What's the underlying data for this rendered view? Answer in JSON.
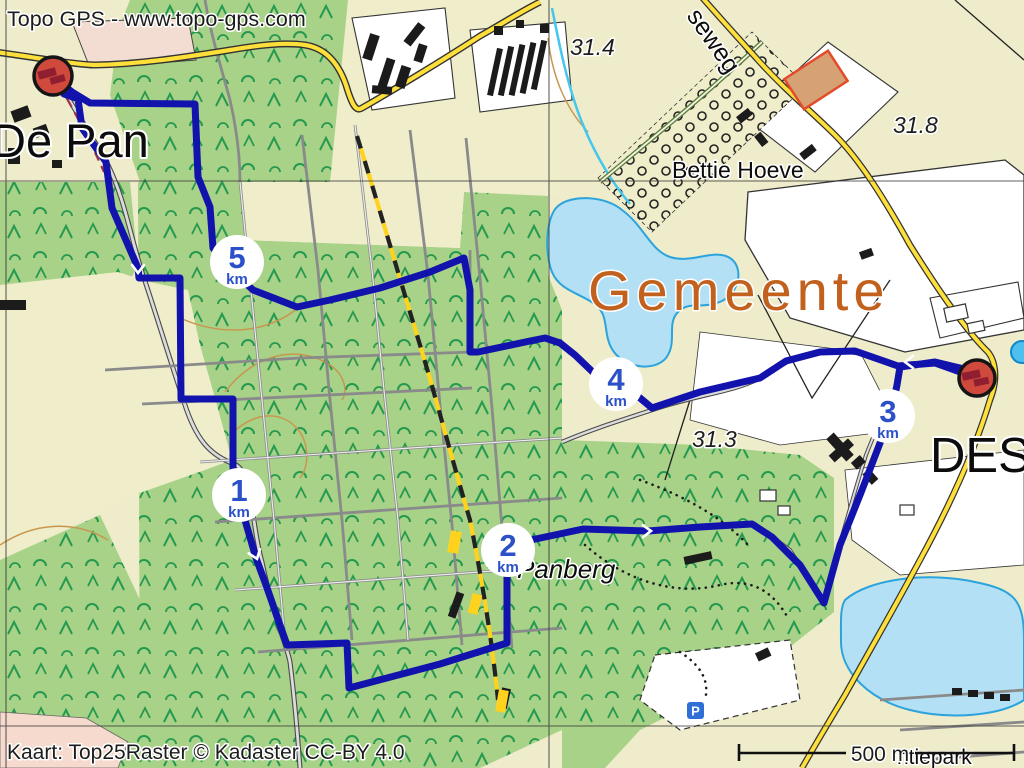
{
  "header": {
    "brand": "Topo GPS - www.topo-gps.com"
  },
  "footer": {
    "attribution": "Kaart: Top25Raster © Kadaster CC-BY 4.0",
    "scale_label": "500 m"
  },
  "map": {
    "labels": {
      "place_top_left": "De Pan",
      "municipality": "Gemeente",
      "farm": "Bettie Hoeve",
      "area_hill": "Panberg",
      "road_partial": "seweg",
      "place_right_partial": "DES",
      "park_partial": "ntiepark",
      "parking_symbol": "P",
      "elevation_a": "31.4",
      "elevation_b": "31.8",
      "elevation_c": "31.3"
    },
    "route": {
      "color": "#1213ad",
      "km_markers": [
        {
          "value": "1",
          "unit": "km"
        },
        {
          "value": "2",
          "unit": "km"
        },
        {
          "value": "3",
          "unit": "km"
        },
        {
          "value": "4",
          "unit": "km"
        },
        {
          "value": "5",
          "unit": "km"
        }
      ]
    },
    "colors": {
      "forest": "#a7d288",
      "field": "#eeeccb",
      "water": "#b3e0f4",
      "road_yellow": "#ffdf3a",
      "municipality_label": "#c2601d",
      "marker_red": "#cf4a3d"
    }
  }
}
